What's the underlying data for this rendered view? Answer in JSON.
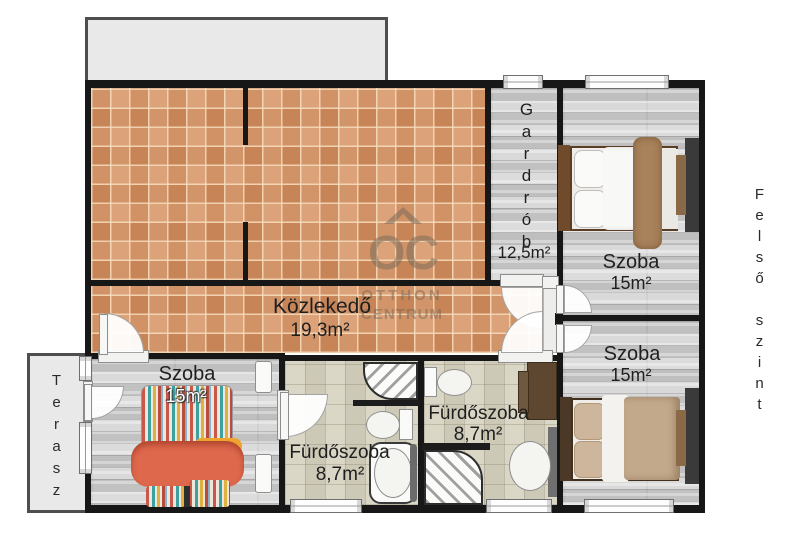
{
  "plan_title": "floor plan – upper level",
  "floor_label": "Felső szint",
  "watermark": {
    "monogram": "OC",
    "line1": "OTTHON",
    "line2": "CENTRUM"
  },
  "rooms": {
    "gardrob": {
      "name": "Gardrób",
      "area": "12,5m²"
    },
    "kozlekedo": {
      "name": "Közlekedő",
      "area": "19,3m²"
    },
    "szoba_tr": {
      "name": "Szoba",
      "area": "15m²"
    },
    "szoba_mr": {
      "name": "Szoba",
      "area": "15m²"
    },
    "szoba_bl": {
      "name": "Szoba",
      "area": "15m²"
    },
    "furdo_left": {
      "name": "Fürdőszoba",
      "area": "8,7m²"
    },
    "furdo_mid": {
      "name": "Fürdőszoba",
      "area": "8,7m²"
    },
    "terasz": {
      "name": "Terasz"
    }
  },
  "colors": {
    "wall": "#171717",
    "tile_terracotta": "#d79465",
    "wood_gray": "#d6d6d6",
    "bath_beige": "#d6d2c0",
    "outdoor_gray": "#e9e9e9",
    "blanket_orange": "#de684c",
    "blanket_yellow": "#eda42f",
    "blanket_brown": "#a8825b",
    "duvet_tan": "#c3a98c",
    "furniture_dark": "#3a3a3a",
    "furniture_brown": "#8a6947"
  }
}
